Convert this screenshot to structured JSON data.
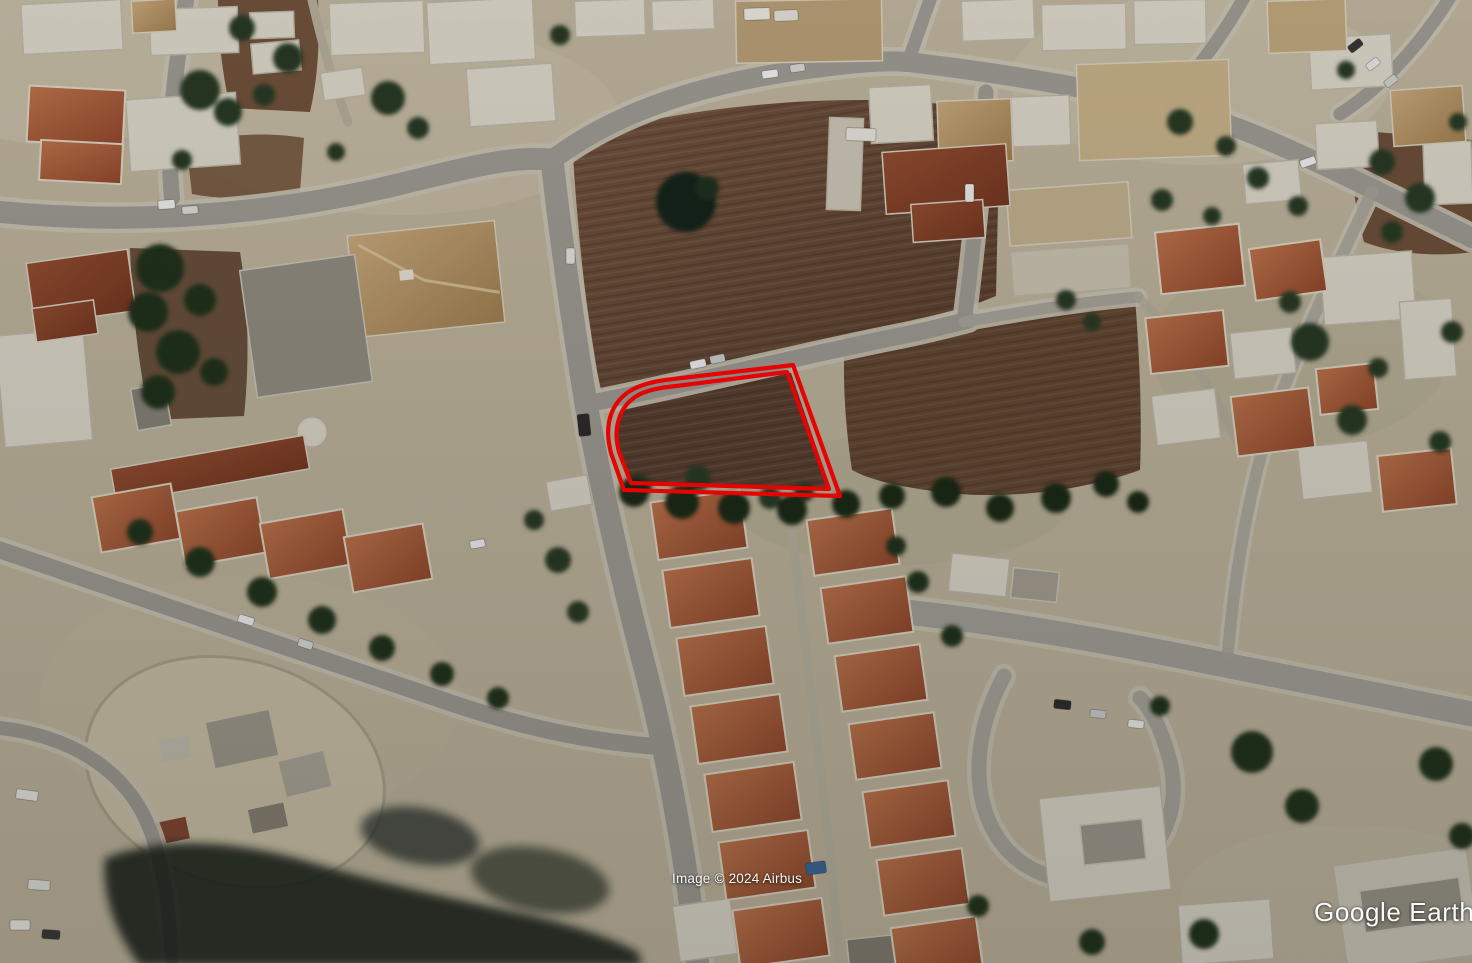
{
  "app": {
    "name": "Google Earth",
    "view_type": "oblique aerial satellite imagery"
  },
  "watermarks": {
    "attribution": "Image © 2024 Airbus",
    "logo": "Google Earth"
  },
  "overlay": {
    "label": "land-plot-boundary",
    "color": "#e60303",
    "stroke_width": 4.2,
    "outer_path": "M793,365 L665,380 C637,384 620,393 612,412 C606,427 608,441 611,453 L624,490 L840,496 Z",
    "inner_path": "M787,372 L668,387 C642,390 627,398 620,416 C615,429 616,440 619,452 L631,483 L829,489 Z"
  },
  "scene": {
    "description": "Residential neighborhood seen from above: terracotta hip-roofed houses, white flat-roofed buildings, light gray streets, dark green trees, brown vacant dirt plots; a double red outline marks a vacant corner plot at centre.",
    "ground_color": "#cabfa7",
    "road_color": "#a8a49c",
    "sidewalk_color": "#d7d0bf",
    "dirt_color": "#6d4e3a",
    "roof_orange": "#b4603c",
    "roof_rust": "#8d4a30",
    "roof_white": "#e9e4d6",
    "roof_tan": "#c8a36a",
    "tree_color": "#2a3e25"
  }
}
